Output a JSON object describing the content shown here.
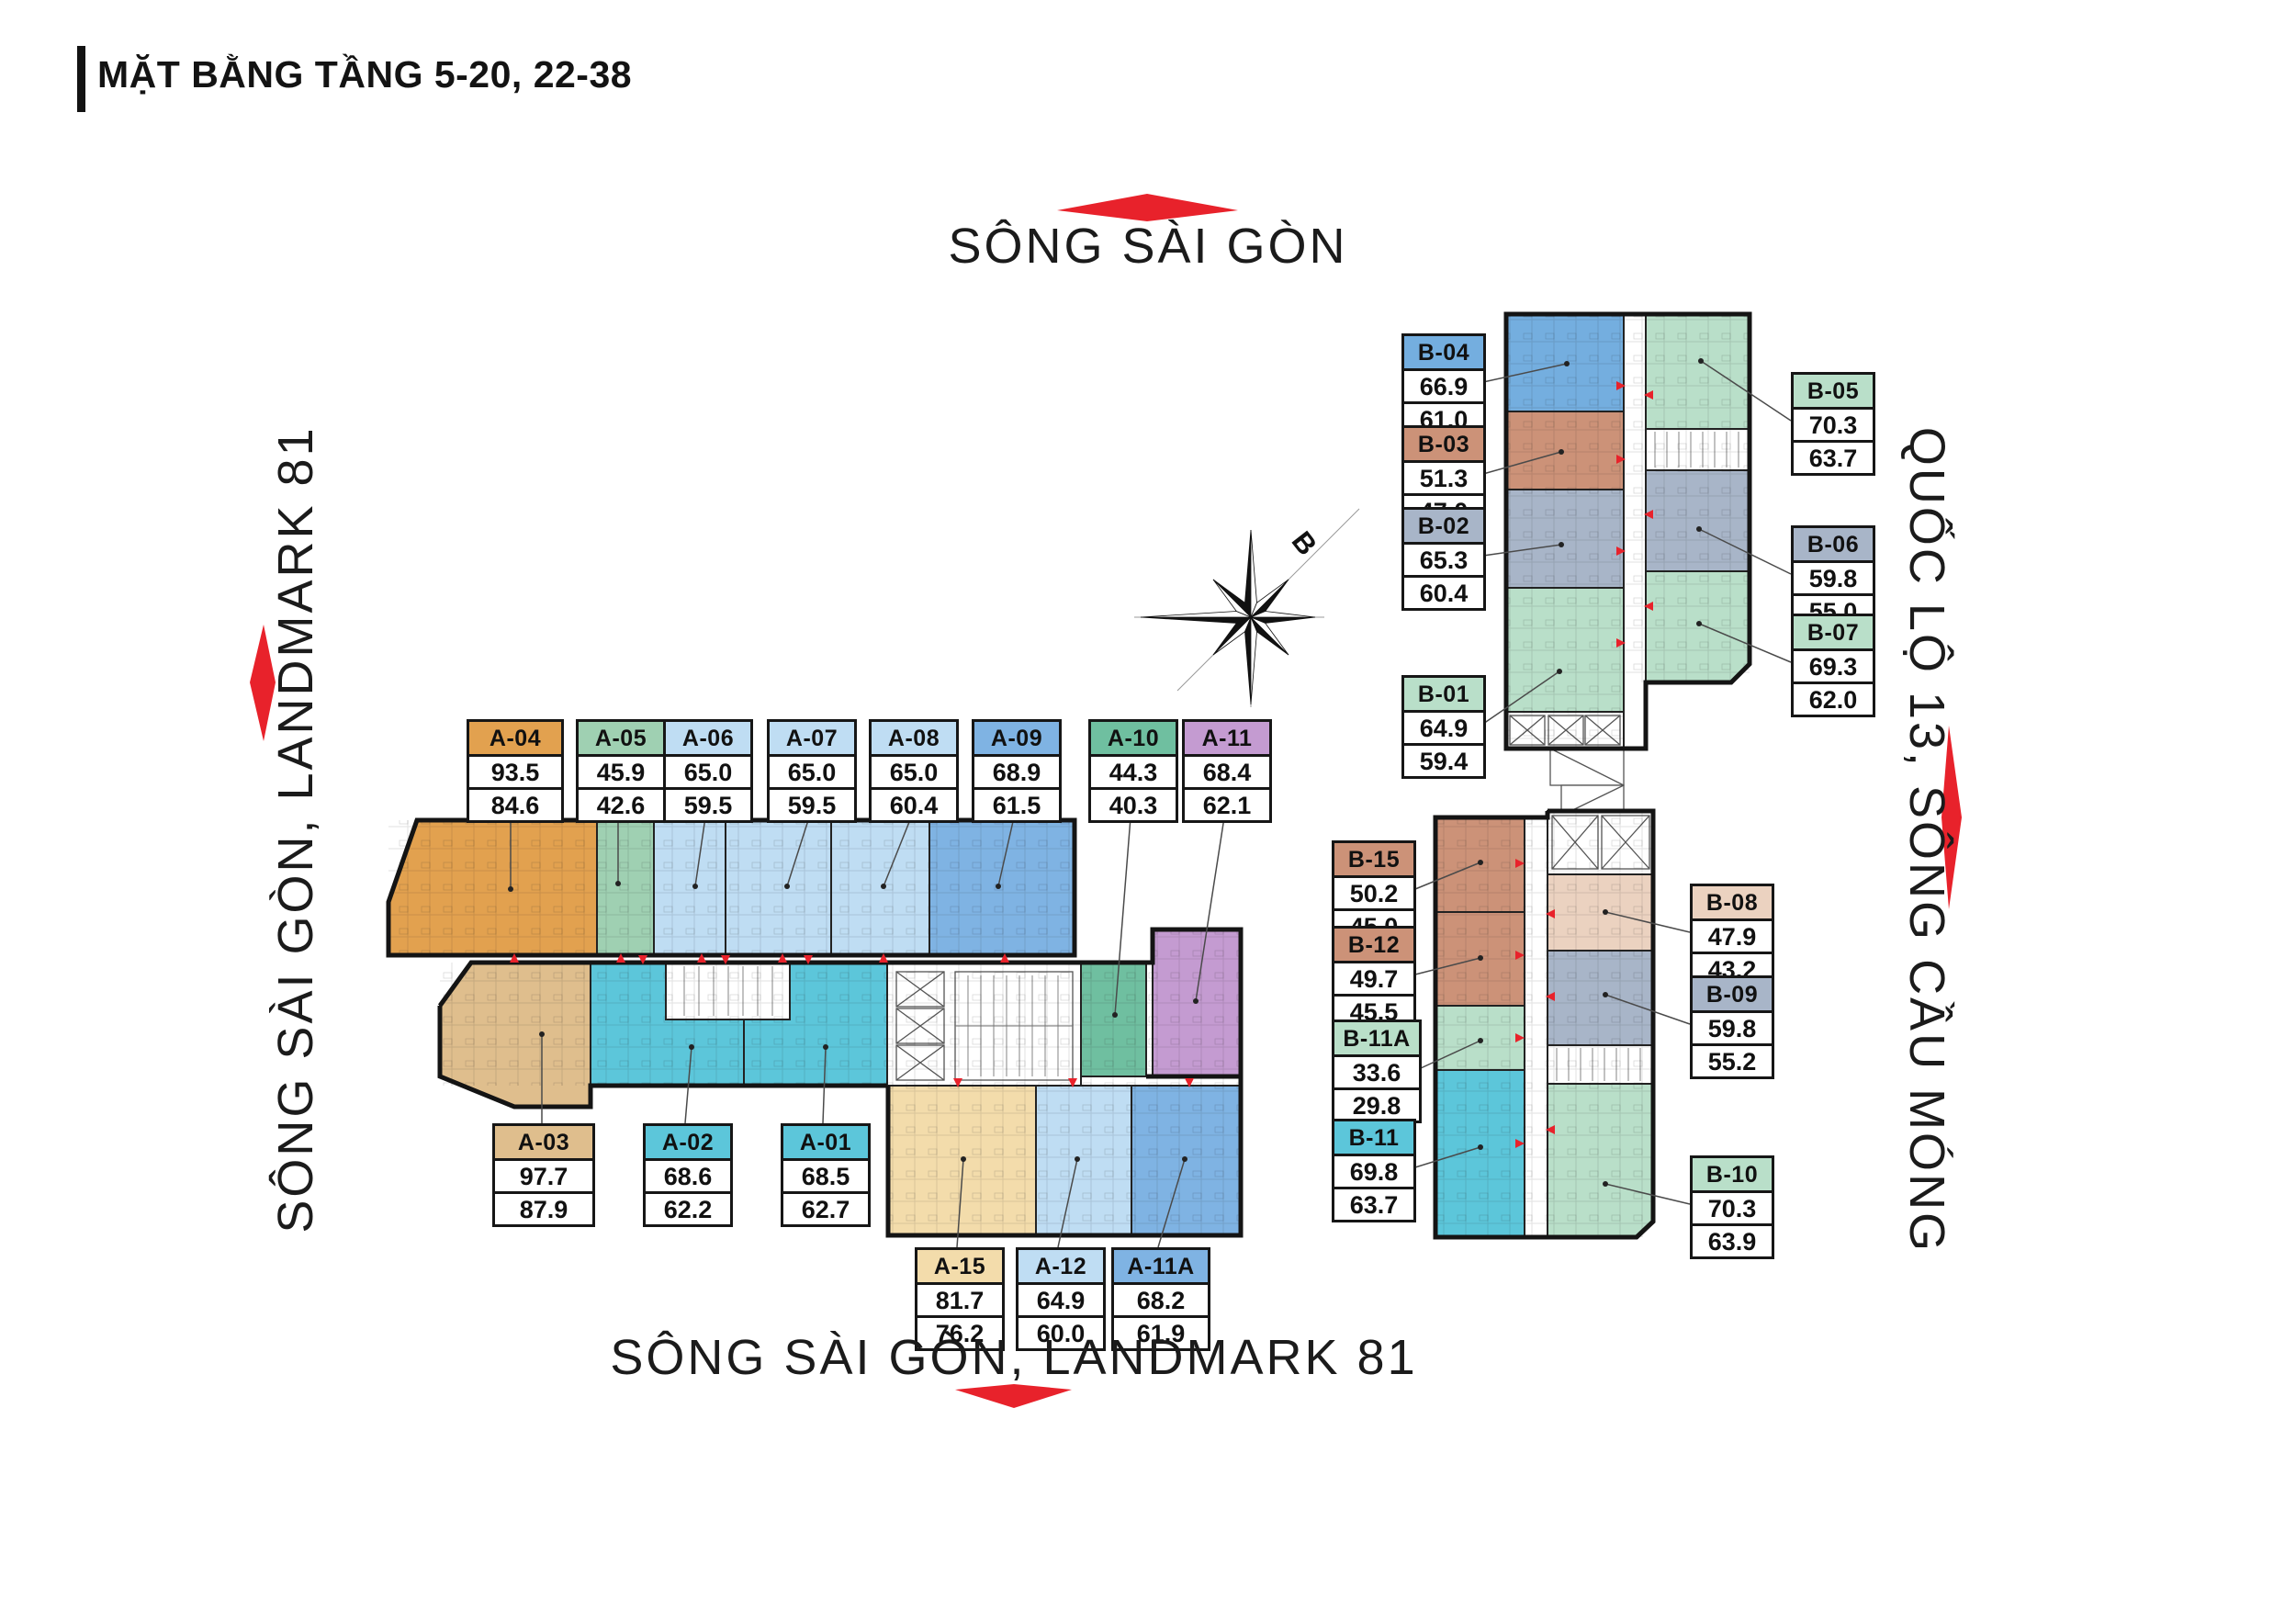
{
  "title": "MẶT BẰNG TẦNG 5-20, 22-38",
  "landmarks": {
    "top": "SÔNG SÀI GÒN",
    "left": "SÔNG SÀI GÒN, LANDMARK 81",
    "right": "QUỐC LỘ 13, SÔNG CẦU MÓNG",
    "bottom": "SÔNG SÀI GÒN, LANDMARK 81"
  },
  "compass": {
    "north_label": "B"
  },
  "palette": {
    "red": "#E8222B",
    "orange": "#E2A14F",
    "tan": "#DFBE8D",
    "light_tan": "#F3DCAB",
    "mint": "#9FD0B2",
    "teal_green": "#6FBFA0",
    "light_blue": "#BFDDF3",
    "mid_blue": "#7FB3E3",
    "cyan": "#5CC6DA",
    "purple": "#C49BD1",
    "salmon": "#CC9278",
    "light_salmon": "#EBD2C0",
    "blue_gray": "#A8B5C8",
    "blue": "#74AEDF",
    "mint_light": "#B9DFC9",
    "wall": "#141414"
  },
  "units": {
    "a01": {
      "name": "A-01",
      "area": "68.5",
      "carpet": "62.7",
      "color": "cyan"
    },
    "a02": {
      "name": "A-02",
      "area": "68.6",
      "carpet": "62.2",
      "color": "cyan"
    },
    "a03": {
      "name": "A-03",
      "area": "97.7",
      "carpet": "87.9",
      "color": "tan"
    },
    "a04": {
      "name": "A-04",
      "area": "93.5",
      "carpet": "84.6",
      "color": "orange"
    },
    "a05": {
      "name": "A-05",
      "area": "45.9",
      "carpet": "42.6",
      "color": "mint"
    },
    "a06": {
      "name": "A-06",
      "area": "65.0",
      "carpet": "59.5",
      "color": "light_blue"
    },
    "a07": {
      "name": "A-07",
      "area": "65.0",
      "carpet": "59.5",
      "color": "light_blue"
    },
    "a08": {
      "name": "A-08",
      "area": "65.0",
      "carpet": "60.4",
      "color": "light_blue"
    },
    "a09": {
      "name": "A-09",
      "area": "68.9",
      "carpet": "61.5",
      "color": "mid_blue"
    },
    "a10": {
      "name": "A-10",
      "area": "44.3",
      "carpet": "40.3",
      "color": "teal_green"
    },
    "a11": {
      "name": "A-11",
      "area": "68.4",
      "carpet": "62.1",
      "color": "purple"
    },
    "a11a": {
      "name": "A-11A",
      "area": "68.2",
      "carpet": "61.9",
      "color": "mid_blue"
    },
    "a12": {
      "name": "A-12",
      "area": "64.9",
      "carpet": "60.0",
      "color": "light_blue"
    },
    "a15": {
      "name": "A-15",
      "area": "81.7",
      "carpet": "76.2",
      "color": "light_tan"
    },
    "b01": {
      "name": "B-01",
      "area": "64.9",
      "carpet": "59.4",
      "color": "mint_light"
    },
    "b02": {
      "name": "B-02",
      "area": "65.3",
      "carpet": "60.4",
      "color": "blue_gray"
    },
    "b03": {
      "name": "B-03",
      "area": "51.3",
      "carpet": "47.0",
      "color": "salmon"
    },
    "b04": {
      "name": "B-04",
      "area": "66.9",
      "carpet": "61.0",
      "color": "blue"
    },
    "b05": {
      "name": "B-05",
      "area": "70.3",
      "carpet": "63.7",
      "color": "mint_light"
    },
    "b06": {
      "name": "B-06",
      "area": "59.8",
      "carpet": "55.0",
      "color": "blue_gray"
    },
    "b07": {
      "name": "B-07",
      "area": "69.3",
      "carpet": "62.0",
      "color": "mint_light"
    },
    "b08": {
      "name": "B-08",
      "area": "47.9",
      "carpet": "43.2",
      "color": "light_salmon"
    },
    "b09": {
      "name": "B-09",
      "area": "59.8",
      "carpet": "55.2",
      "color": "blue_gray"
    },
    "b10": {
      "name": "B-10",
      "area": "70.3",
      "carpet": "63.9",
      "color": "mint_light"
    },
    "b11": {
      "name": "B-11",
      "area": "69.8",
      "carpet": "63.7",
      "color": "cyan"
    },
    "b11a": {
      "name": "B-11A",
      "area": "33.6",
      "carpet": "29.8",
      "color": "mint_light"
    },
    "b12": {
      "name": "B-12",
      "area": "49.7",
      "carpet": "45.5",
      "color": "salmon"
    },
    "b15": {
      "name": "B-15",
      "area": "50.2",
      "carpet": "45.0",
      "color": "salmon"
    }
  }
}
